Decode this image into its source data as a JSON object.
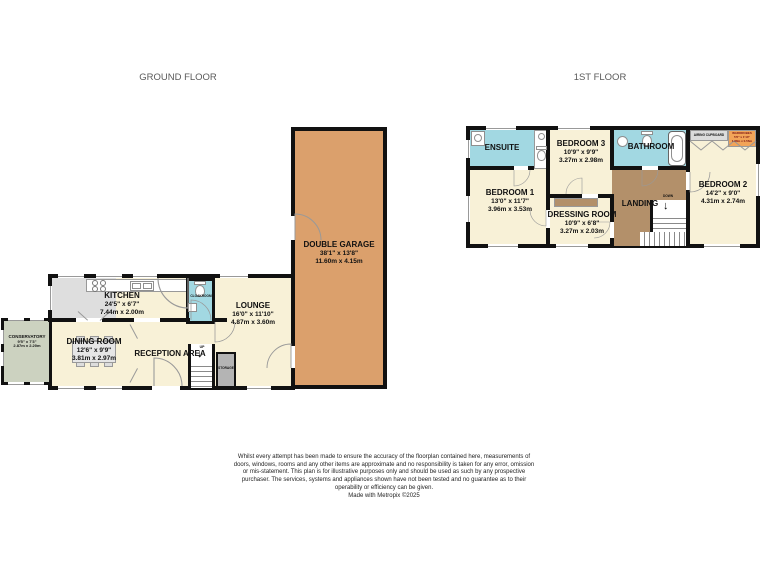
{
  "header": {
    "ground_floor_title": "GROUND FLOOR",
    "first_floor_title": "1ST FLOOR"
  },
  "ground_floor": {
    "double_garage": {
      "name": "DOUBLE GARAGE",
      "imperial": "38'1\" x 13'8\"",
      "metric": "11.60m x 4.15m"
    },
    "kitchen": {
      "name": "KITCHEN",
      "imperial": "24'5\" x 6'7\"",
      "metric": "7.44m x 2.00m"
    },
    "lounge": {
      "name": "LOUNGE",
      "imperial": "16'0\" x 11'10\"",
      "metric": "4.87m x 3.60m"
    },
    "dining_room": {
      "name": "DINING ROOM",
      "imperial": "12'6\" x 9'9\"",
      "metric": "3.81m x 2.97m"
    },
    "conservatory": {
      "name": "CONSERVATORY",
      "imperial": "9'5\" x 7'3\"",
      "metric": "2.87m x 2.20m"
    },
    "reception_area": {
      "name": "RECEPTION AREA"
    },
    "cloakroom": {
      "name": "CLOAKROOM"
    },
    "storage": {
      "name": "STORAGE"
    },
    "stairs": {
      "label": "UP",
      "arrow": "↓"
    }
  },
  "first_floor": {
    "bedroom_1": {
      "name": "BEDROOM 1",
      "imperial": "13'0\" x 11'7\"",
      "metric": "3.96m x 3.53m"
    },
    "bedroom_2": {
      "name": "BEDROOM 2",
      "imperial": "14'2\" x 9'0\"",
      "metric": "4.31m x 2.74m"
    },
    "bedroom_3": {
      "name": "BEDROOM 3",
      "imperial": "10'9\" x 9'9\"",
      "metric": "3.27m x 2.98m"
    },
    "dressing_room": {
      "name": "DRESSING ROOM",
      "imperial": "10'9\" x 6'8\"",
      "metric": "3.27m x 2.03m"
    },
    "ensuite": {
      "name": "ENSUITE"
    },
    "bathroom": {
      "name": "BATHROOM"
    },
    "landing": {
      "name": "LANDING"
    },
    "airing_cupboard": {
      "name": "AIRING CUPBOARD"
    },
    "wardrobes": {
      "name": "WARDROBES",
      "imperial": "5'6\" x 1'10\"",
      "metric": "1.68m x 0.56m"
    },
    "stairs": {
      "label": "DOWN",
      "arrow": "↓"
    }
  },
  "footer": {
    "disclaimer": "Whilst every attempt has been made to ensure the accuracy of the floorplan contained here, measurements of doors, windows, rooms and any other items are approximate and no responsibility is taken for any error, omission or mis-statement. This plan is for illustrative purposes only and should be used as such by any prospective purchaser. The services, systems and appliances shown have not been tested and no guarantee as to their operability or efficiency can be given.",
    "credit": "Made with Metropix ©2025"
  },
  "colors": {
    "wall": "#111111",
    "room_cream": "#f8f1d7",
    "garage_orange": "#dba06c",
    "wet_room_blue": "#a2d8e2",
    "landing_brown": "#b3906a",
    "conservatory_green": "#ccd2c0",
    "storage_gray": "#b4b4b4",
    "wardrobe_orange": "#f2a458"
  }
}
